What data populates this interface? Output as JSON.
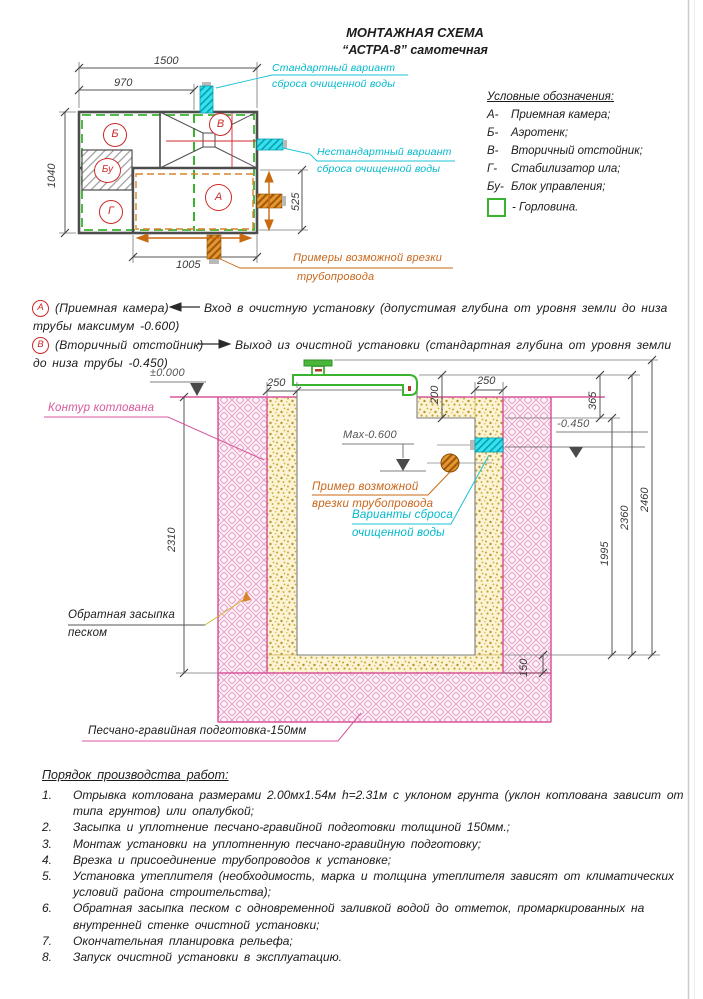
{
  "title": {
    "line1": "МОНТАЖНАЯ СХЕМА",
    "line2": "“АСТРА-8” самотечная"
  },
  "legend": {
    "header": "Условные обозначения:",
    "items": [
      {
        "key": "А-",
        "label": "Приемная камера;"
      },
      {
        "key": "Б-",
        "label": "Аэротенк;"
      },
      {
        "key": "В-",
        "label": "Вторичный отстойник;"
      },
      {
        "key": "Г-",
        "label": "Стабилизатор ила;"
      },
      {
        "key": "Бу-",
        "label": "Блок управления;"
      },
      {
        "key": "",
        "label": "- Горловина."
      }
    ]
  },
  "plan": {
    "sections": {
      "b": "Б",
      "v": "В",
      "bu": "Бу",
      "g": "Г",
      "a": "А"
    },
    "dims": {
      "w1500": "1500",
      "w970": "970",
      "h1040": "1040",
      "w1005": "1005",
      "h525": "525"
    },
    "labels": {
      "standard1": "Стандартный вариант",
      "standard2": "сброса очищенной воды",
      "nonstandard1": "Нестандартный вариант",
      "nonstandard2": "сброса очищенной воды",
      "pipes1": "Примеры возможной врезки",
      "pipes2": "трубопровода"
    }
  },
  "notes": {
    "a": {
      "badge": "А",
      "name": "(Приемная камера)",
      "text1": "Вход в очистную установку (допустимая глубина от уровня земли до низа",
      "text2": "трубы максимум -0.600)"
    },
    "b": {
      "badge": "В",
      "name": "(Вторичный отстойник)",
      "text1": "Выход из очистной установки (стандартная глубина от уровня земли",
      "text2": "до низа трубы -0.450)"
    }
  },
  "section": {
    "levels": {
      "zero": "±0.000",
      "max": "Max-0.600",
      "out": "-0.450"
    },
    "dims": {
      "left250": "250",
      "right250": "250",
      "step200": "200",
      "top365": "365",
      "pit2310": "2310",
      "tank1995": "1995",
      "unit2360": "2360",
      "total2460": "2460",
      "bed150": "150"
    },
    "labels": {
      "contour": "Контур котлована",
      "pipe1": "Пример возможной",
      "pipe2": "врезки трубопровода",
      "discharge1": "Варианты сброса",
      "discharge2": "очищенной воды",
      "backfill1": "Обратная засыпка",
      "backfill2": "песком",
      "bed": "Песчано-гравийная подготовка-150мм"
    }
  },
  "worklist": {
    "header": "Порядок производства работ:",
    "items": [
      {
        "num": "1.",
        "lines": [
          "Отрывка котлована размерами 2.00мх1.54м h=2.31м с уклоном грунта (уклон котлована зависит от",
          "типа грунтов) или опалубкой;"
        ]
      },
      {
        "num": "2.",
        "lines": [
          "Засыпка и уплотнение песчано-гравийной подготовки толщиной 150мм.;"
        ]
      },
      {
        "num": "3.",
        "lines": [
          "Монтаж установки на уплотненную песчано-гравийную подготовку;"
        ]
      },
      {
        "num": "4.",
        "lines": [
          "Врезка и присоединение трубопроводов к установке;"
        ]
      },
      {
        "num": "5.",
        "lines": [
          "Установка утеплителя (необходимость, марка и толщина утеплителя зависят от климатических",
          "условий района строительства);"
        ]
      },
      {
        "num": "6.",
        "lines": [
          "Обратная засыпка песком с одновременной заливкой водой до отметок, промаркированных на",
          "внутренней стенке очистной установки;"
        ]
      },
      {
        "num": "7.",
        "lines": [
          "Окончательная планировка рельефа;"
        ]
      },
      {
        "num": "8.",
        "lines": [
          "Запуск очистной установки в эксплуатацию."
        ]
      }
    ]
  },
  "colors": {
    "cyan": "#00b9cc",
    "pink": "#d8569c",
    "green": "#3ab32f",
    "orange": "#d9832a",
    "red": "#cc2a2a"
  }
}
